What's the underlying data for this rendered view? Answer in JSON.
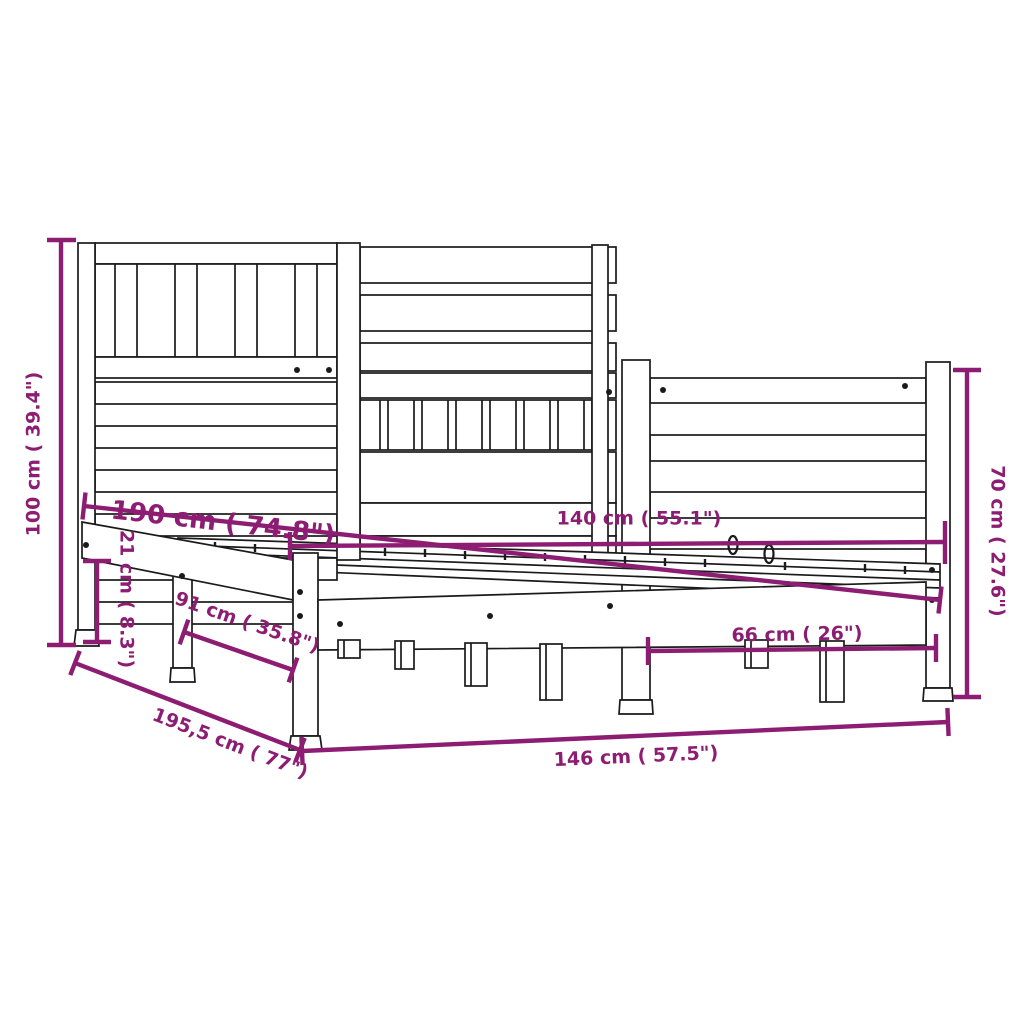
{
  "diagram": {
    "type": "product-dimension-drawing",
    "subject": "bed-frame-with-headboard",
    "background_color": "#ffffff",
    "line_color": "#1a1a1a",
    "accent_color": "#8D1D72",
    "dimensions": {
      "headboard_height": "100 cm ( 39.4\")",
      "mattress_length": "190 cm ( 74.8\")",
      "side_rail_height": "21 cm ( 8.3\")",
      "side_depth": "91 cm ( 35.8\")",
      "total_length": "195,5 cm ( 77\")",
      "mattress_width": "140 cm ( 55.1\")",
      "footboard_inner_width": "66 cm ( 26\")",
      "total_width": "146 cm ( 57.5\")",
      "footboard_height": "70 cm ( 27.6\")"
    }
  }
}
